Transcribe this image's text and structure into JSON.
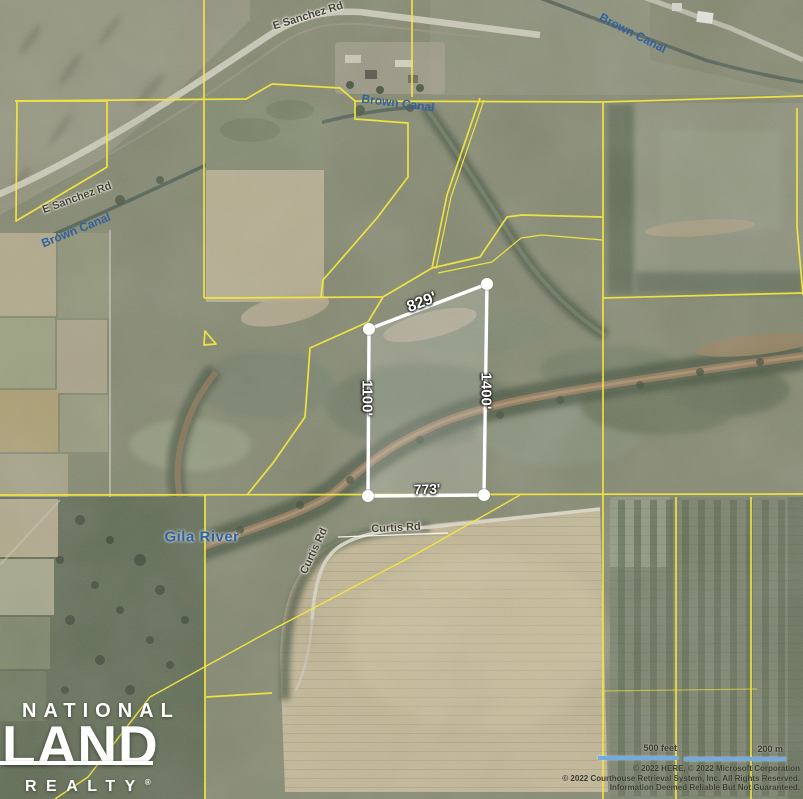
{
  "map": {
    "labels": {
      "e_sanchez_rd_top": "E Sanchez Rd",
      "e_sanchez_rd_left": "E Sanchez Rd",
      "brown_canal_right": "Brown Canal",
      "brown_canal_center": "Brown Canal",
      "brown_canal_left": "Brown Canal",
      "gila_river": "Gila River",
      "curtis_rd_vertical": "Curtis Rd",
      "curtis_rd_horizontal": "Curtis Rd"
    },
    "parcel": {
      "dimensions": {
        "top": "829'",
        "right": "1400'",
        "left": "1100'",
        "bottom": "773'"
      }
    },
    "scale_bar": {
      "feet_label": "500 feet",
      "meters_label": "200 m"
    },
    "attribution": {
      "line1": "© 2022 HERE, © 2022 Microsoft Corporation",
      "line2": "© 2022 Courthouse Retrieval System, Inc. All Rights Reserved.",
      "line3": "Information Deemed Reliable But Not Guaranteed."
    },
    "logo": {
      "line1": "NATIONAL",
      "line2": "LAND",
      "line3": "REALTY",
      "registered": "®"
    },
    "colors": {
      "parcel_boundary": "#f3e73e",
      "highlight_parcel": "#ffffff",
      "water_label": "#2f5f9d",
      "scale_bar": "#73aadf"
    }
  }
}
